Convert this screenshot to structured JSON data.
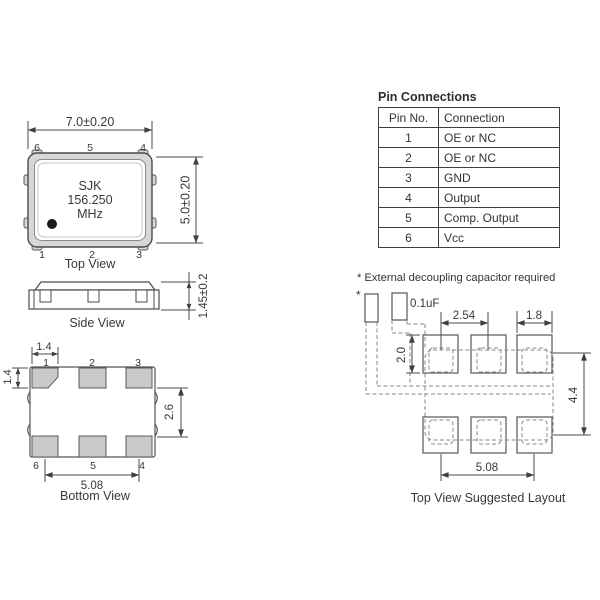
{
  "top_view": {
    "label": "Top View",
    "dim_width": "7.0±0.20",
    "dim_height": "5.0±0.20",
    "chip": {
      "line1": "SJK",
      "line2": "156.250",
      "line3": "MHz"
    },
    "pins_top": [
      "6",
      "5",
      "4"
    ],
    "pins_bottom": [
      "1",
      "2",
      "3"
    ]
  },
  "side_view": {
    "label": "Side View",
    "dim_height": "1.45±0.2"
  },
  "bottom_view": {
    "label": "Bottom View",
    "dim_pad_width": "1.4",
    "dim_pad_height": "1.4",
    "dim_row_gap": "2.6",
    "dim_span": "5.08",
    "pins_top": [
      "1",
      "2",
      "3"
    ],
    "pins_bottom": [
      "6",
      "5",
      "4"
    ]
  },
  "pin_table": {
    "title": "Pin Connections",
    "headers": [
      "Pin No.",
      "Connection"
    ],
    "rows": [
      [
        "1",
        "OE or NC"
      ],
      [
        "2",
        "OE or NC"
      ],
      [
        "3",
        "GND"
      ],
      [
        "4",
        "Output"
      ],
      [
        "5",
        "Comp. Output"
      ],
      [
        "6",
        "Vcc"
      ]
    ]
  },
  "note": "* External decoupling capacitor required",
  "layout": {
    "label": "Top View Suggested Layout",
    "cap_marker": "*",
    "cap_value": "0.1uF",
    "dim_pitch": "2.54",
    "dim_pad_width": "1.8",
    "dim_pad_height": "2.0",
    "dim_row_span": "4.4",
    "dim_col_span": "5.08"
  },
  "colors": {
    "line": "#4b4b4b",
    "dashed": "#8a8a8a",
    "pad_fill": "#c9c9c9",
    "body_fill": "#d7d7d7"
  }
}
